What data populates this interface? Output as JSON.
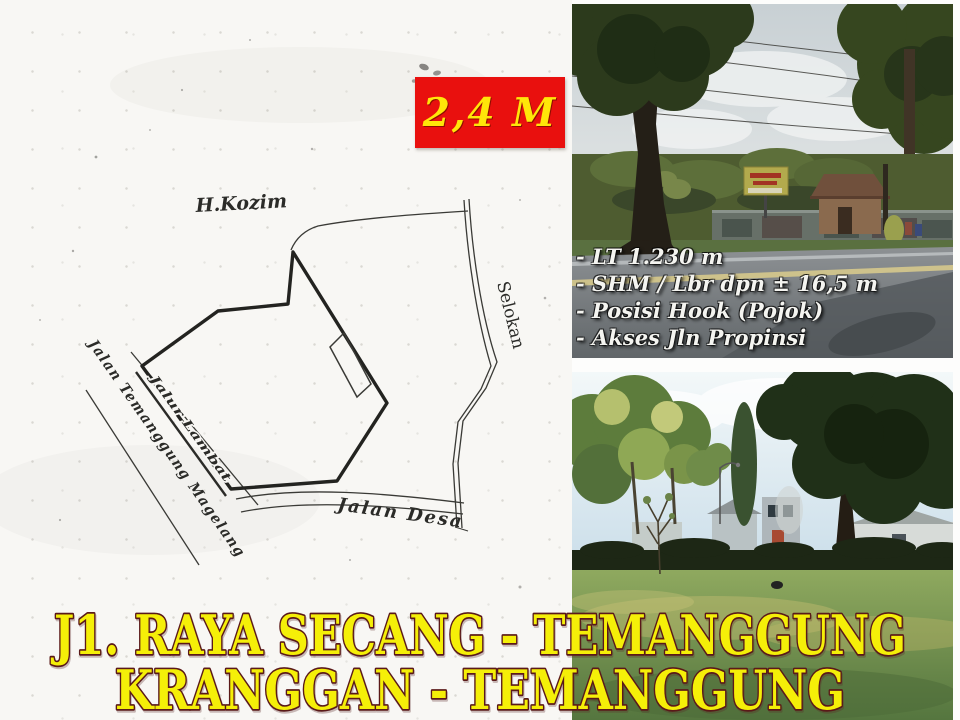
{
  "flyer": {
    "price_tag": {
      "label": "2,4 M"
    },
    "site_plan": {
      "neighbor_label": "H.Kozim",
      "ditch_label": "Selokan",
      "village_road_label": "Jalan Desa",
      "highway_label": "Jalan Temanggung Magelang",
      "frontage_lane_label": "Jalur Lambat"
    },
    "details": {
      "items": [
        "- LT 1.230 m",
        "- SHM / Lbr dpn ± 16,5 m",
        "- Posisi Hook (Pojok)",
        "- Akses Jln Propinsi"
      ]
    },
    "title": {
      "line1": "J1. RAYA SECANG - TEMANGGUNG",
      "line2": "KRANGGAN - TEMANGGUNG"
    },
    "colors": {
      "price_bg": "#e9100e",
      "price_fg": "#ffe609",
      "title_fill": "#f5ef08",
      "title_outline": "#5a1919",
      "map_ink": "#2b2b28"
    }
  }
}
